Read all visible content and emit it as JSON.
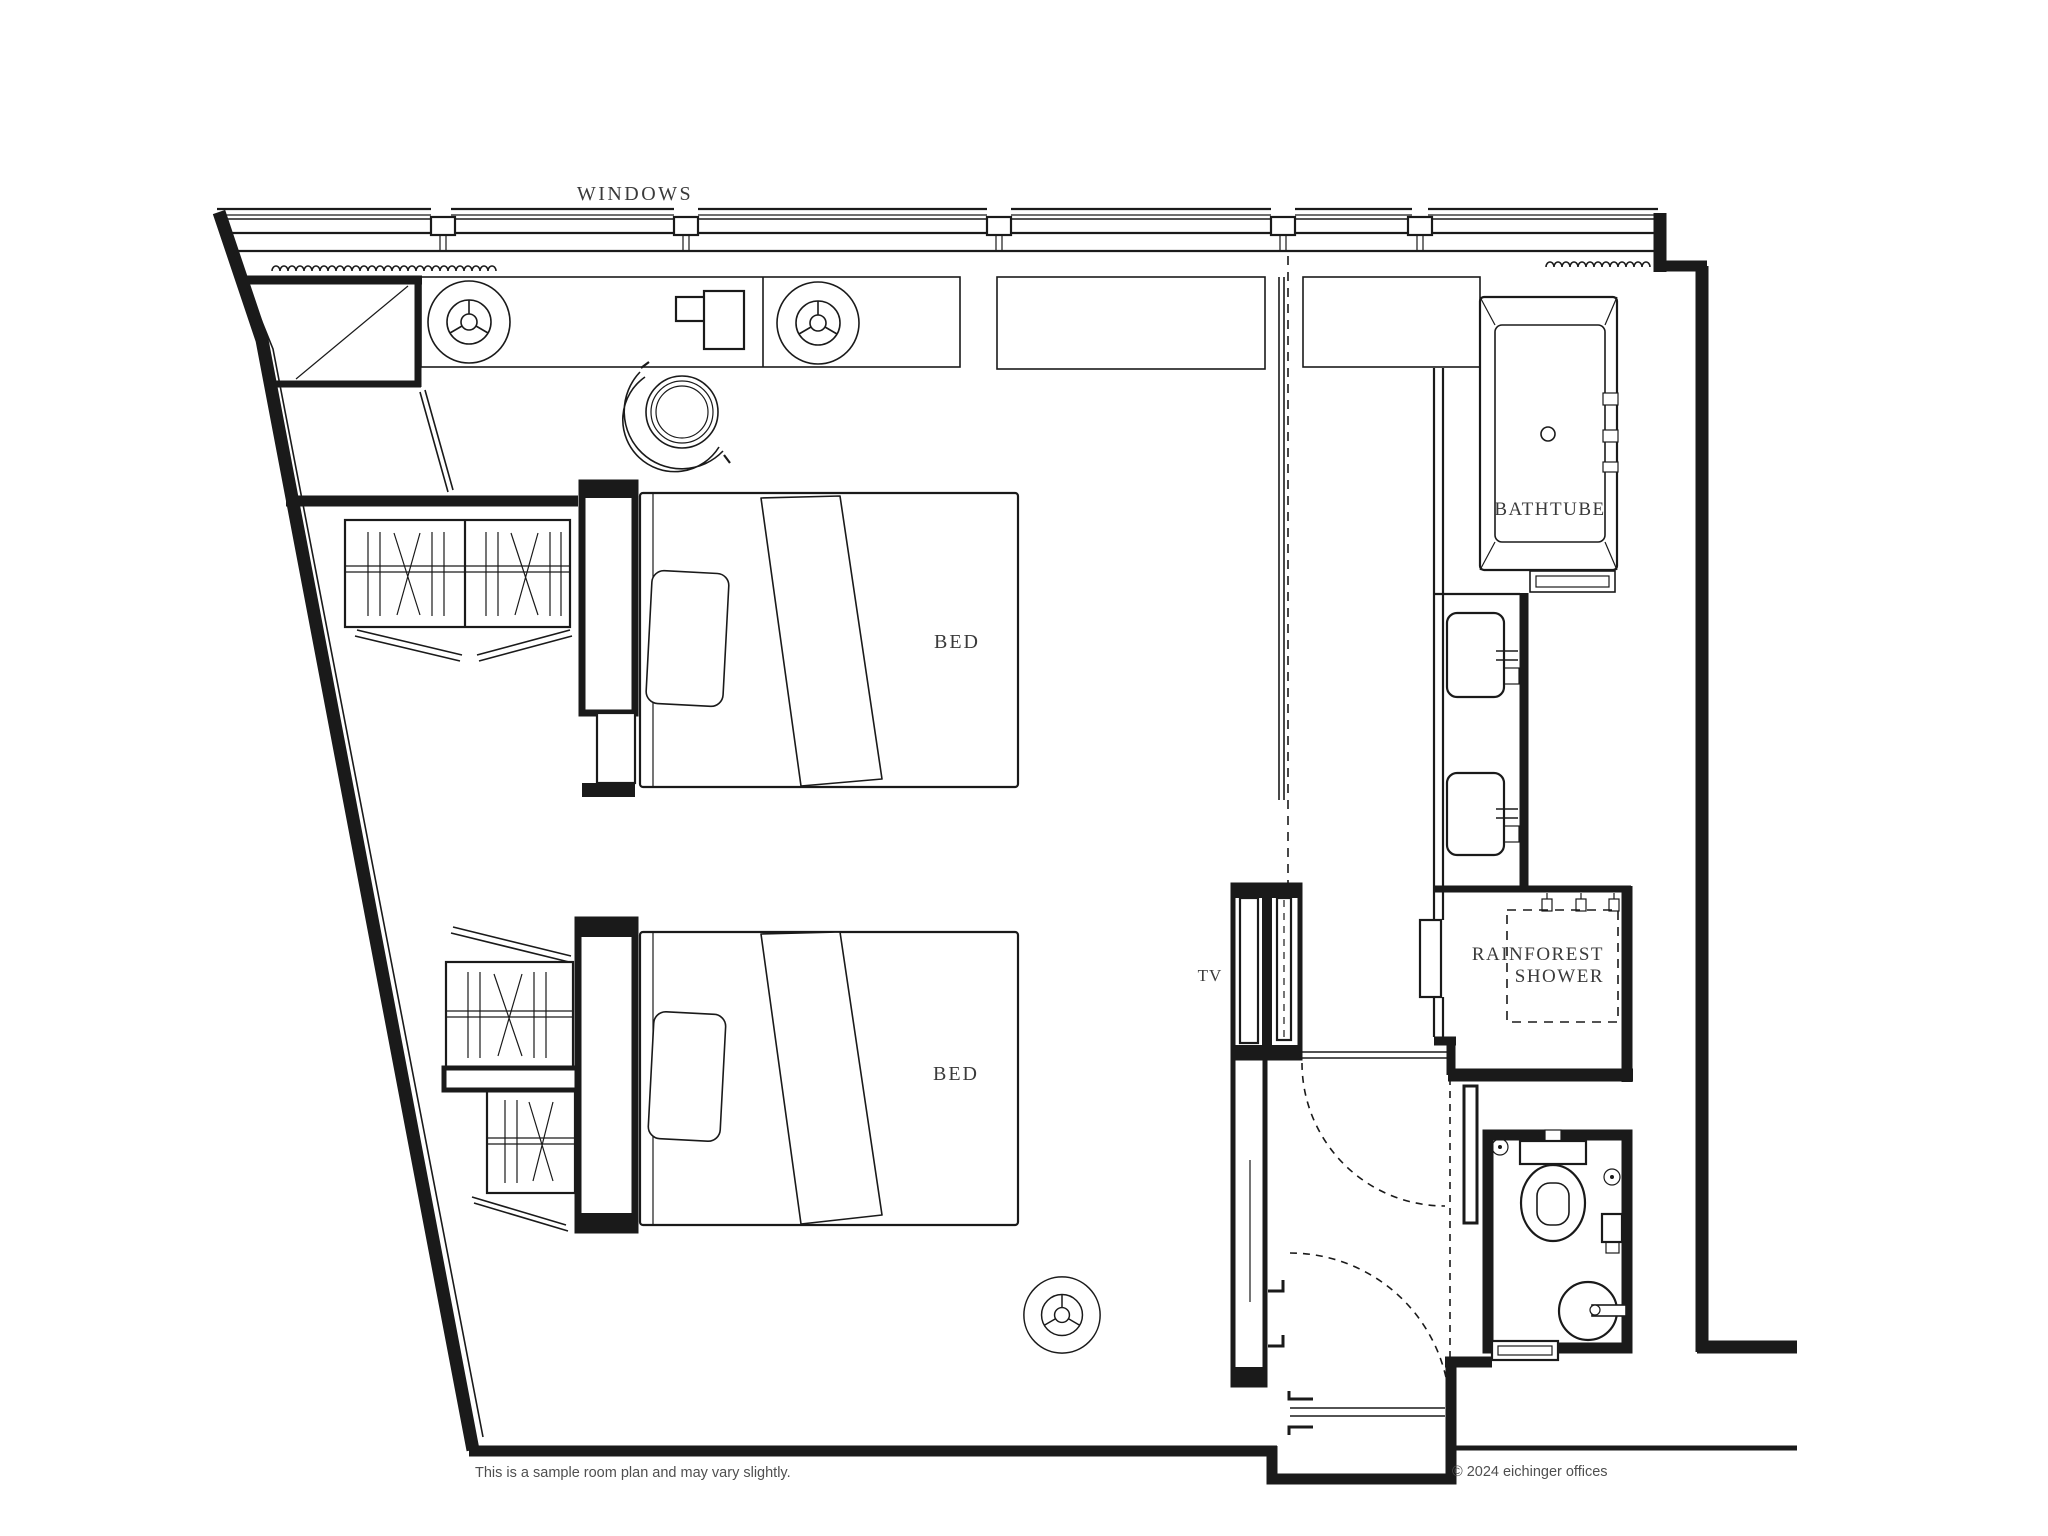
{
  "plan": {
    "labels": {
      "windows": "WINDOWS",
      "bed_upper": "BED",
      "bed_lower": "BED",
      "tv": "TV",
      "bathtub": "BATHTUBE",
      "shower_line1": "RAINFOREST",
      "shower_line2": "SHOWER"
    }
  },
  "footer": {
    "disclaimer": "This is a sample room plan and may vary slightly.",
    "copyright": "© 2024 eichinger offices"
  },
  "colors": {
    "background": "#ffffff",
    "line": "#1a1a1a",
    "label_text": "#3a3a3a",
    "footer_text": "#4f4f4f"
  }
}
